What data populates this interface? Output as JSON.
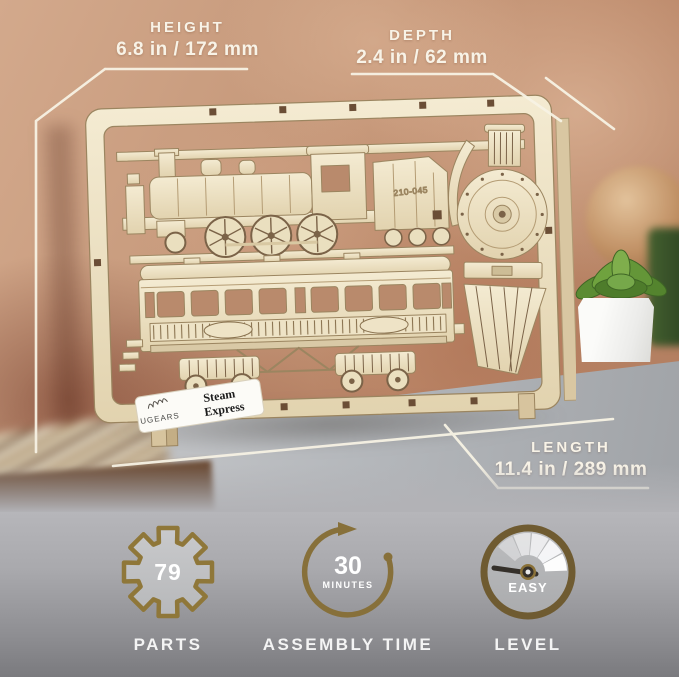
{
  "callouts": {
    "height": {
      "label": "HEIGHT",
      "value": "6.8 in / 172 mm"
    },
    "depth": {
      "label": "DEPTH",
      "value": "2.4 in / 62 mm"
    },
    "length": {
      "label": "LENGTH",
      "value": "11.4 in / 289 mm"
    }
  },
  "model": {
    "brand": "UGEARS",
    "name_line1": "Steam",
    "name_line2": "Express",
    "locomotive_number": "210-045"
  },
  "specs": [
    {
      "icon": "gear-icon",
      "value": "79",
      "label": "PARTS"
    },
    {
      "icon": "circular-arrow-icon",
      "value": "30",
      "unit": "MINUTES",
      "label": "ASSEMBLY TIME"
    },
    {
      "icon": "gauge-icon",
      "value": "EASY",
      "label": "LEVEL"
    }
  ],
  "colors": {
    "accent_bronze": "#8a7138",
    "callout_text": "#f8f3e7",
    "spec_text": "#f4f4f4",
    "plywood": "#ecdfc2",
    "wall_terracotta": "#c2947a",
    "table_gray": "#aeb1b5"
  }
}
